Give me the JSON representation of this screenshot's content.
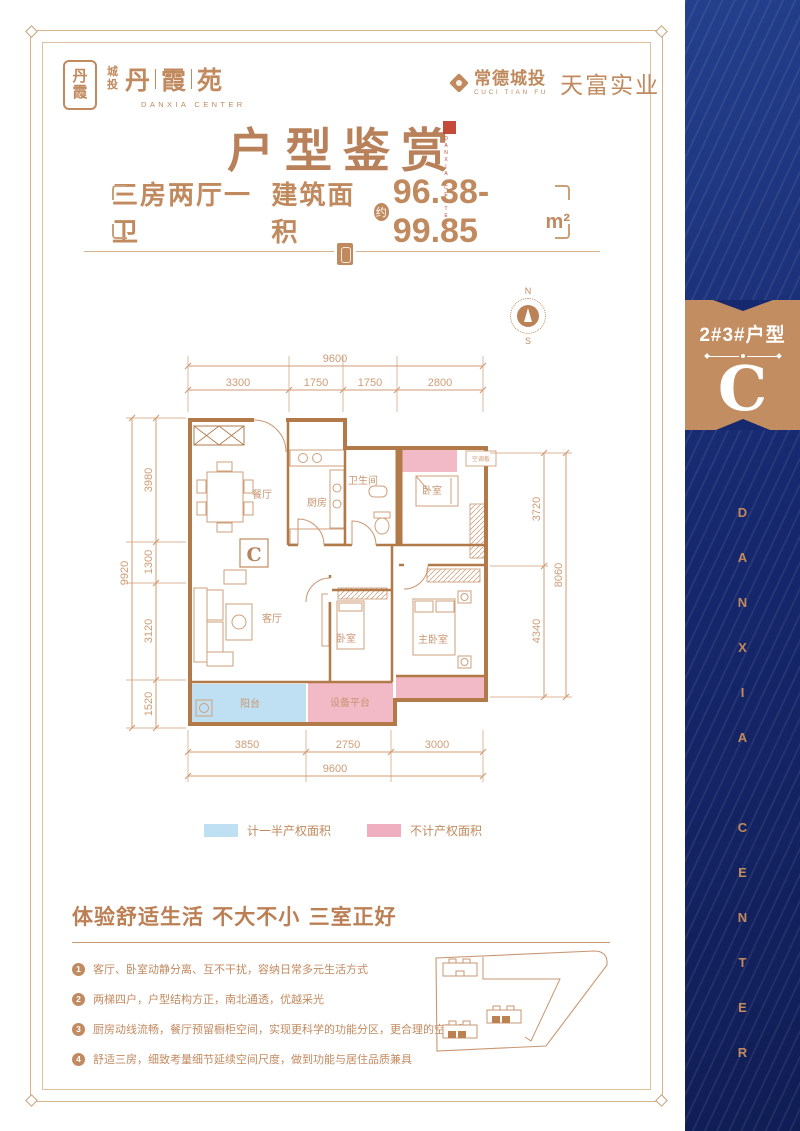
{
  "colors": {
    "accent": "#C08A5E",
    "navy": "#16286E",
    "wall": "#B27949",
    "pink": "#F2B9C7",
    "blue": "#BFE0F3",
    "seal_red": "#C44A3A"
  },
  "brand": {
    "seal_top": "丹",
    "seal_bottom": "霞",
    "prefix_top": "城",
    "prefix_bottom": "投",
    "name": [
      "丹",
      "霞",
      "苑"
    ],
    "name_en": "DANXIA CENTER",
    "partner_name": "常德城投",
    "partner_en": "CUCI TIAN FU",
    "partner_company": "天富实业"
  },
  "title": {
    "text": "户型鉴赏",
    "seal_caption": "DANXIA CENTER"
  },
  "subtitle": {
    "layout": "三房两厅一卫",
    "area_label": "建筑面积",
    "approx": "约",
    "value": "96.38-99.85",
    "unit": "m²"
  },
  "compass": {
    "n": "N",
    "s": "S"
  },
  "sidebar": {
    "unit_title": "2#3#户型",
    "unit_letter": "C",
    "vertical_text": "DANXIA CENTER"
  },
  "floorplan": {
    "unit_mark": "C",
    "rooms": {
      "dining": "餐厅",
      "kitchen": "厨房",
      "bathroom": "卫生间",
      "bedroom_a": "卧室",
      "living": "客厅",
      "bedroom_b": "卧室",
      "master": "主卧室",
      "balcony": "阳台",
      "equipment": "设备平台",
      "ac": "空调板"
    },
    "dims": {
      "top_total": "9600",
      "top": [
        "3300",
        "1750",
        "1750",
        "2800"
      ],
      "left_total": "9920",
      "left": [
        "3980",
        "1300",
        "3120",
        "1520"
      ],
      "right": [
        "3720",
        "4340"
      ],
      "right_total": "8060",
      "bottom": [
        "3850",
        "2750",
        "3000"
      ],
      "bottom_total": "9600"
    }
  },
  "legend": {
    "items": [
      {
        "label": "计一半产权面积",
        "color": "#BFE0F3"
      },
      {
        "label": "不计产权面积",
        "color": "#EFAFC0"
      }
    ]
  },
  "features": {
    "heading": "体验舒适生活 不大不小 三室正好",
    "bullets": [
      {
        "num": "1",
        "text": "客厅、卧室动静分离、互不干扰，容纳日常多元生活方式"
      },
      {
        "num": "2",
        "text": "两梯四户，户型结构方正，南北通透，优越采光"
      },
      {
        "num": "3",
        "text": "厨房动线流畅，餐厅预留橱柜空间，实现更科学的功能分区，更合理的空间利用"
      },
      {
        "num": "4",
        "text": "舒适三房，细致考量细节延续空间尺度，做到功能与居住品质兼具"
      }
    ]
  }
}
